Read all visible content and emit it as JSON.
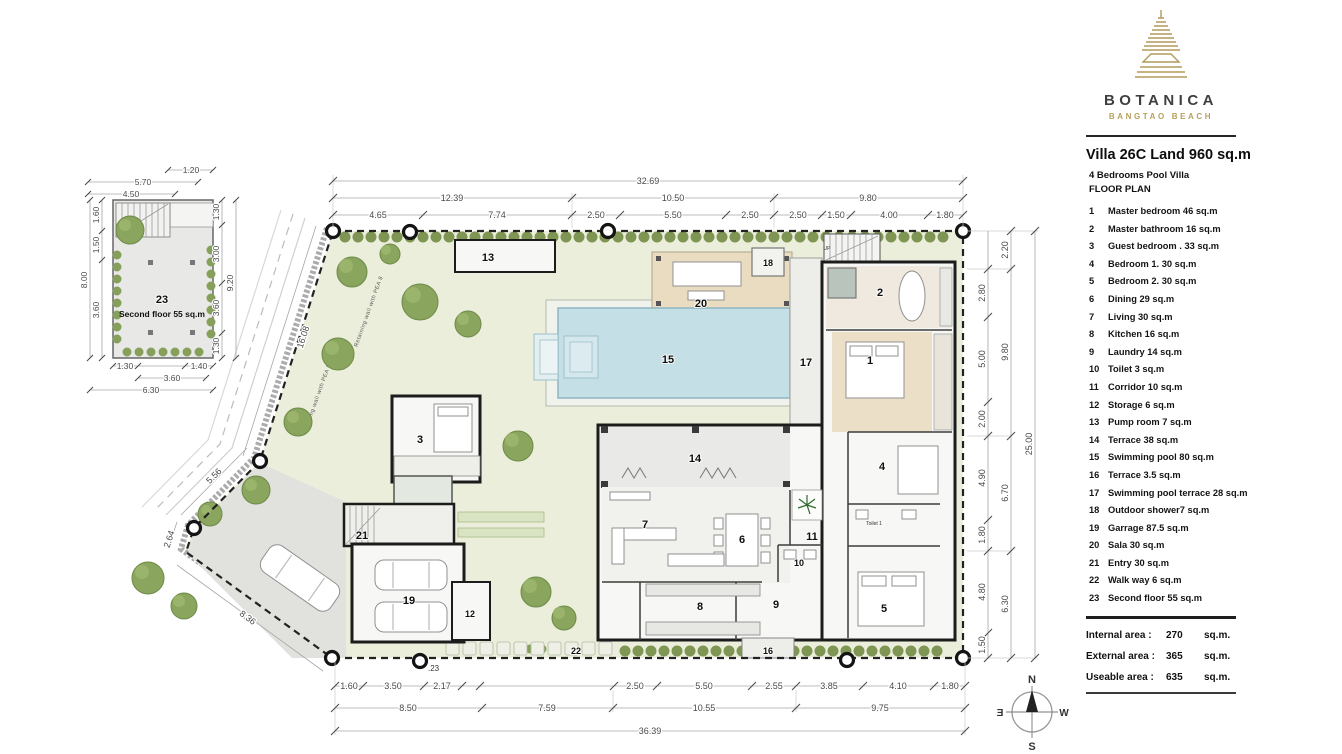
{
  "branding": {
    "name": "BOTANICA",
    "subtitle": "BANGTAO BEACH"
  },
  "header": {
    "title": "Villa 26C Land 960 sq.m",
    "subtitle": "4  Bedrooms  Pool  Villa",
    "plan_label": "FLOOR  PLAN"
  },
  "legend": {
    "items": [
      {
        "num": "1",
        "label": "Master bedroom 46 sq.m"
      },
      {
        "num": "2",
        "label": "Master bathroom 16 sq.m"
      },
      {
        "num": "3",
        "label": "Guest bedroom . 33 sq.m"
      },
      {
        "num": "4",
        "label": "Bedroom 1. 30 sq.m"
      },
      {
        "num": "5",
        "label": "Bedroom 2. 30 sq.m"
      },
      {
        "num": "6",
        "label": "Dining  29 sq.m"
      },
      {
        "num": "7",
        "label": "Living  30  sq.m"
      },
      {
        "num": "8",
        "label": "Kitchen  16 sq.m"
      },
      {
        "num": "9",
        "label": "Laundry  14 sq.m"
      },
      {
        "num": "10",
        "label": "Toilet  3 sq.m"
      },
      {
        "num": "11",
        "label": "Corridor  10 sq.m"
      },
      {
        "num": "12",
        "label": "Storage 6 sq.m"
      },
      {
        "num": "13",
        "label": "Pump room 7 sq.m"
      },
      {
        "num": "14",
        "label": "Terrace 38 sq.m"
      },
      {
        "num": "15",
        "label": "Swimming pool 80 sq.m"
      },
      {
        "num": "16",
        "label": "Terrace 3.5 sq.m"
      },
      {
        "num": "17",
        "label": "Swimming pool terrace  28 sq.m"
      },
      {
        "num": "18",
        "label": "Outdoor shower7 sq.m"
      },
      {
        "num": "19",
        "label": "Garrage  87.5 sq.m"
      },
      {
        "num": "20",
        "label": "Sala 30 sq.m"
      },
      {
        "num": "21",
        "label": "Entry 30 sq.m"
      },
      {
        "num": "22",
        "label": "Walk way 6 sq.m"
      },
      {
        "num": "23",
        "label": "Second floor 55 sq.m"
      }
    ]
  },
  "totals": {
    "rows": [
      {
        "label": "Internal area :",
        "value": "270",
        "unit": "sq.m."
      },
      {
        "label": "External area :",
        "value": "365",
        "unit": "sq.m."
      },
      {
        "label": "Useable area :",
        "value": "635",
        "unit": "sq.m."
      }
    ]
  },
  "compass": {
    "n": "N",
    "e": "E",
    "s": "S",
    "w": "W"
  },
  "plan": {
    "rooms": [
      "1",
      "2",
      "3",
      "4",
      "5",
      "6",
      "7",
      "8",
      "9",
      "10",
      "11",
      "12",
      "13",
      "14",
      "15",
      "16",
      "17",
      "18",
      "19",
      "20",
      "21",
      "22"
    ],
    "toilet_label": "Toilet 1",
    "up_label": "UP",
    "wall_note": "Retaining wall with PEA 8",
    "marker_note": ".23",
    "dims": {
      "top_overall": "32.69",
      "top_mid": [
        "12.39",
        "10.50",
        "9.80"
      ],
      "top": [
        "4.65",
        "7.74",
        "2.50",
        "5.50",
        "2.50",
        "2.50",
        "1.50",
        "4.00",
        "1.80"
      ],
      "bottom": [
        "1.60",
        "3.50",
        "2.17",
        "2.50",
        "5.50",
        "2.55",
        "3.85",
        "4.10",
        "1.80"
      ],
      "bottom_mid": [
        "8.50",
        "7.59",
        "10.55",
        "9.75"
      ],
      "bottom_overall": "36.39",
      "right": [
        "2.80",
        "5.00",
        "2.00",
        "4.90",
        "1.80",
        "4.80",
        "1.50"
      ],
      "right_mid": [
        "2.20",
        "9.80",
        "6.70",
        "6.30"
      ],
      "right_overall": "25.00",
      "left": [
        "16.08",
        "5.56",
        "2.64",
        "8.36"
      ]
    }
  },
  "second_floor": {
    "num": "23",
    "label": "Second floor 55 sq.m",
    "dims": {
      "top": [
        "1.20",
        "5.70",
        "4.50"
      ],
      "left": [
        "1.60",
        "1.50",
        "3.60"
      ],
      "left_overall": "8.00",
      "right": [
        "1.30",
        "3.00",
        "3.60",
        "1.30"
      ],
      "right_overall": "9.20",
      "bottom": [
        "1.30",
        "1.40"
      ],
      "bottom_mid": "3.60",
      "bottom_overall": "6.30"
    }
  },
  "colors": {
    "accent_gold": "#b49a5c",
    "site_green": "#eaeeda",
    "pool_blue": "#c5dfe7",
    "hedge_green": "#7e9553",
    "wall_dark": "#1c1c1c"
  }
}
